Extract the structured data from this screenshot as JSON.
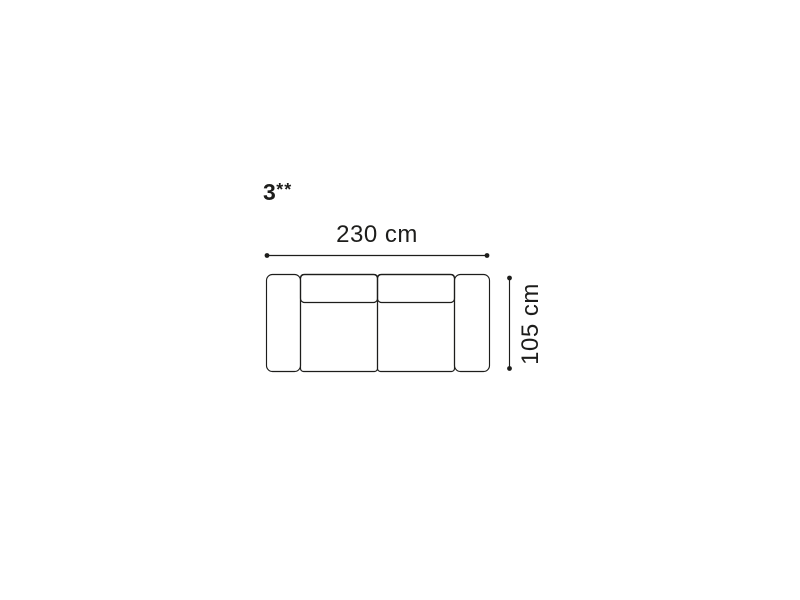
{
  "page": {
    "background": "#ffffff",
    "ink_color": "#1d1d1b"
  },
  "diagram": {
    "kind": "sofa-top-view-dimension-drawing",
    "variant": {
      "base": "3",
      "mark": "**"
    },
    "dimensions": {
      "width": {
        "label": "230 cm",
        "value_cm": 230,
        "orientation": "horizontal"
      },
      "depth": {
        "label": "105 cm",
        "value_cm": 105,
        "orientation": "vertical"
      }
    },
    "parts": {
      "armrests": 2,
      "seat_cushions": 2,
      "backrest_cushions": 2
    }
  }
}
